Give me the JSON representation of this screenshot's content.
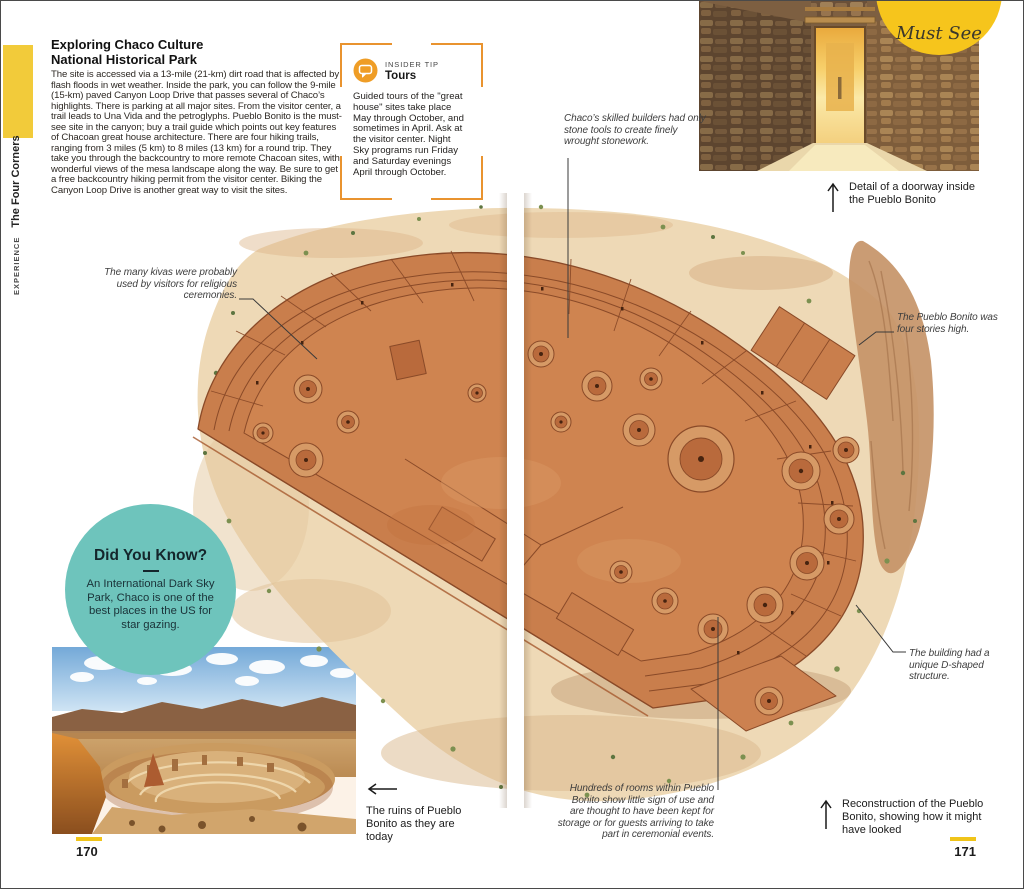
{
  "page": {
    "left_number": "170",
    "right_number": "171"
  },
  "sidebar": {
    "section_label": "EXPERIENCE",
    "chapter_label": "The Four Corners"
  },
  "article": {
    "title_line1": "Exploring Chaco Culture",
    "title_line2": "National Historical Park",
    "body": "The site is accessed via a 13-mile (21-km) dirt road that is affected by flash floods in wet weather. Inside the park, you can follow the 9-mile (15-km) paved Canyon Loop Drive that passes several of Chaco’s highlights. There is parking at all major sites. From the visitor center, a trail leads to Una Vida and the petroglyphs. Pueblo Bonito is the must-see site in the canyon; buy a trail guide which points out key features of Chacoan great house architecture. There are four hiking trails, ranging from 3 miles (5 km) to 8 miles (13 km) for a round trip. They take you through the backcountry to more remote Chacoan sites, with wonderful views of the mesa landscape along the way. Be sure to get a free backcountry hiking permit from the visitor center. Biking the Canyon Loop Drive is another great way to visit the sites."
  },
  "insider_tip": {
    "label": "INSIDER TIP",
    "title": "Tours",
    "body": "Guided tours of the \"great house\" sites take place May through October, and sometimes in April. Ask at the visitor center. Night Sky programs run Friday and Saturday evenings April through October."
  },
  "must_see_badge": {
    "label": "Must See"
  },
  "annotations": {
    "stonework": "Chaco’s skilled builders had only stone tools to create finely wrought stonework.",
    "kivas": "The many kivas were probably used by visitors for religious ceremonies.",
    "stories": "The Pueblo Bonito was four stories high.",
    "d_shape": "The building had a unique D-shaped structure.",
    "rooms": "Hundreds of rooms within Pueblo Bonito show little sign of use and are thought to have been kept for storage or for guests arriving to take part in ceremonial events."
  },
  "photo_captions": {
    "doorway": "Detail of a doorway inside the Pueblo Bonito",
    "ruins": "The ruins of Pueblo Bonito as they are today",
    "reconstruction": "Reconstruction of the Pueblo Bonito, showing how it might have looked"
  },
  "did_you_know": {
    "title": "Did You Know?",
    "body": "An International Dark Sky Park, Chaco is one of the best places in the US for star gazing."
  },
  "icons": {
    "insider_tip_icon": "speech-bubble",
    "doorway_caption_arrow": "up-arrow",
    "ruins_caption_arrow": "left-arrow",
    "reconstruction_caption_arrow": "up-arrow"
  },
  "colors": {
    "sidebar_yellow": "#f2cb3a",
    "badge_yellow": "#f6c51c",
    "tip_orange": "#e9932f",
    "did_you_know_teal": "#6ec4bc",
    "page_dash_yellow": "#f0c419"
  }
}
